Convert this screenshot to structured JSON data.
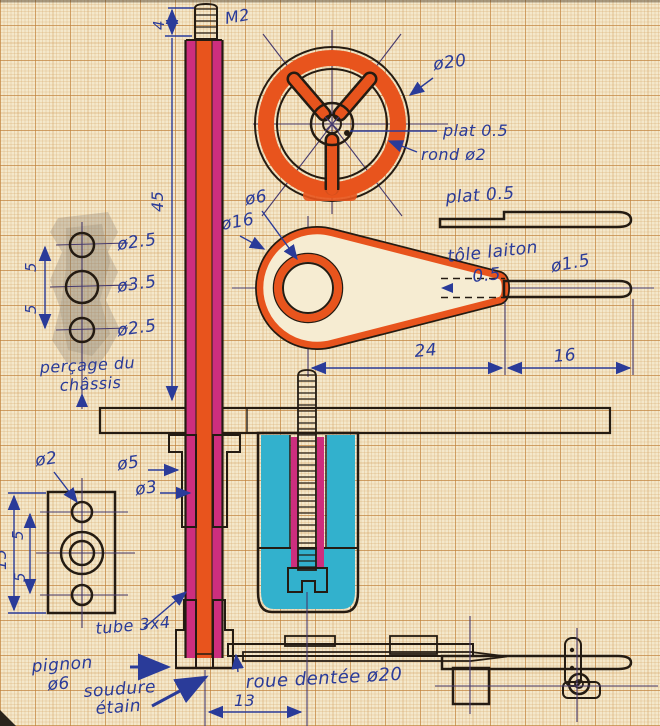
{
  "labels": {
    "m2": "M2",
    "dim_4": "4",
    "dim_45": "45",
    "dia20": "ø20",
    "plat05_wheel": "plat 0.5",
    "rond2": "rond ø2",
    "plat05_bar": "plat 0.5",
    "dia6": "ø6",
    "dia16": "ø16",
    "tole_laiton": "tôle laiton",
    "tole_ep": "0.5",
    "dia15_rod": "ø1.5",
    "dim_24": "24",
    "dim_16": "16",
    "dia25_top": "ø2.5",
    "dia35": "ø3.5",
    "dia25_bot": "ø2.5",
    "dim_5_top": "5",
    "dim_5_bot": "5",
    "percage_1": "perçage du",
    "percage_2": "châssis",
    "dia5": "ø5",
    "dia3": "ø3",
    "dia2": "ø2",
    "dim_15": "15",
    "dim_5_plate_top": "5",
    "dim_5_plate_bot": "5",
    "tube34": "tube 3x4",
    "pignon_1": "pignon",
    "pignon_2": "ø6",
    "soudure_1": "soudure",
    "soudure_2": "étain",
    "roue_dentee": "roue dentée ø20",
    "dim_13": "13"
  },
  "colors": {
    "marker_orange": "#e8541d",
    "marker_magenta": "#cd2e7e",
    "marker_yellow": "#f1d22b",
    "marker_cyan": "#32b1cd",
    "pencil_gray": "#aaa195",
    "ink_blue": "#2a3b99",
    "pen_black": "#241b12",
    "paper": "#f4e8cb"
  }
}
